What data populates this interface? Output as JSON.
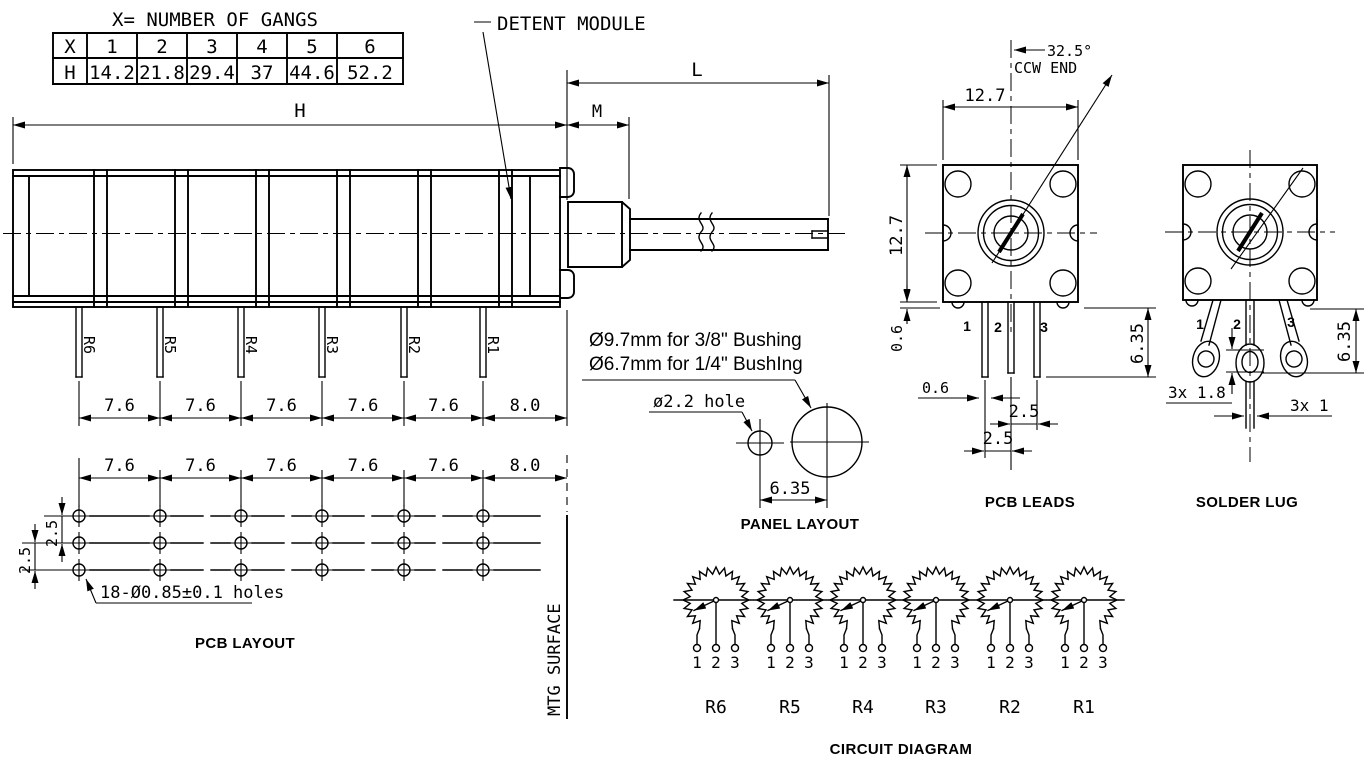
{
  "drawing": {
    "table": {
      "title": "X= NUMBER OF GANGS",
      "rows": [
        {
          "header": "X",
          "cells": [
            "1",
            "2",
            "3",
            "4",
            "5",
            "6"
          ]
        },
        {
          "header": "H",
          "cells": [
            "14.2",
            "21.8",
            "29.4",
            "37",
            "44.6",
            "52.2"
          ]
        }
      ]
    },
    "side_view": {
      "callout": "DETENT MODULE",
      "dims": {
        "h": "H",
        "m": "M",
        "l": "L"
      },
      "pin_labels": [
        "R6",
        "R5",
        "R4",
        "R3",
        "R2",
        "R1"
      ],
      "pitch_dims": [
        "7.6",
        "7.6",
        "7.6",
        "7.6",
        "7.6",
        "8.0"
      ]
    },
    "pcb_layout": {
      "pitch_dims": [
        "7.6",
        "7.6",
        "7.6",
        "7.6",
        "7.6",
        "8.0"
      ],
      "row_dims": [
        "2.5",
        "2.5"
      ],
      "holes_note": "18-Ø0.85±0.1 holes",
      "label": "PCB LAYOUT",
      "mtg_surface": "MTG SURFACE"
    },
    "panel_layout": {
      "note_line1": "Ø9.7mm for 3/8\" Bushing",
      "note_line2": "Ø6.7mm for 1/4\" BushIng",
      "hole_note": "ø2.2 hole",
      "center_dim": "6.35",
      "label": "PANEL LAYOUT"
    },
    "pcb_leads": {
      "angle": "32.5°",
      "ccw_end": "CCW END",
      "dim_width": "12.7",
      "dim_height": "12.7",
      "dim_standoff": "0.6",
      "dim_pin_width": "0.6",
      "dim_pin_length": "6.35",
      "dim_pitch_a": "2.5",
      "dim_pitch_b": "2.5",
      "pin_numbers": [
        "1",
        "2",
        "3"
      ],
      "label": "PCB LEADS"
    },
    "solder_lug": {
      "dim_hole": "3x 1.8",
      "dim_width": "3x 1",
      "dim_length": "6.35",
      "pin_numbers": [
        "1",
        "2",
        "3"
      ],
      "label": "SOLDER LUG"
    },
    "circuit": {
      "resistors": [
        {
          "name": "R6",
          "terminals": [
            "1",
            "2",
            "3"
          ]
        },
        {
          "name": "R5",
          "terminals": [
            "1",
            "2",
            "3"
          ]
        },
        {
          "name": "R4",
          "terminals": [
            "1",
            "2",
            "3"
          ]
        },
        {
          "name": "R3",
          "terminals": [
            "1",
            "2",
            "3"
          ]
        },
        {
          "name": "R2",
          "terminals": [
            "1",
            "2",
            "3"
          ]
        },
        {
          "name": "R1",
          "terminals": [
            "1",
            "2",
            "3"
          ]
        }
      ],
      "label": "CIRCUIT DIAGRAM"
    }
  }
}
